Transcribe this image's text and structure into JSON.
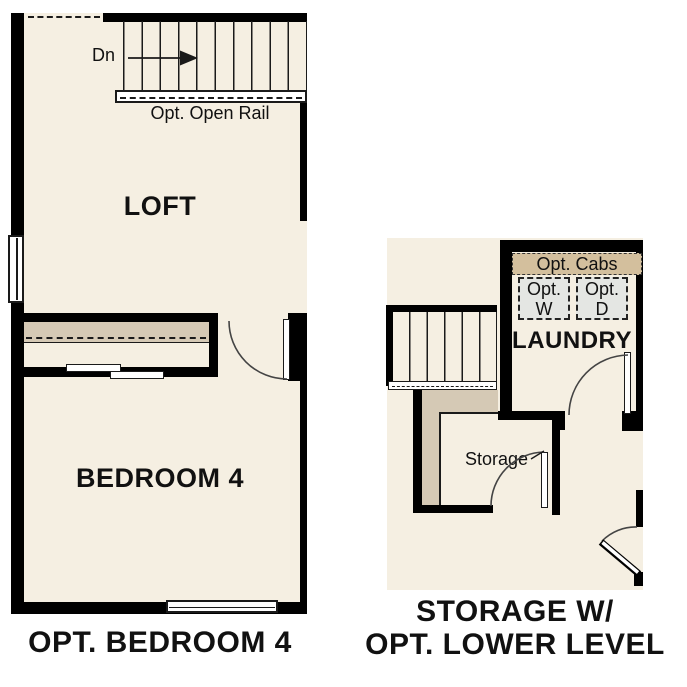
{
  "colors": {
    "floor": "#f5efe2",
    "wall": "#000000",
    "shelf": "#d5c9b5",
    "cabinet": "#d3bf9d",
    "appliance": "#e4e6e3",
    "line": "#1a1a1a"
  },
  "left_plan": {
    "caption": "OPT. BEDROOM 4",
    "loft_label": "LOFT",
    "bedroom_label": "BEDROOM 4",
    "stairs_direction_label": "Dn",
    "rail_label": "Opt. Open Rail"
  },
  "right_plan": {
    "caption_line1": "STORAGE W/",
    "caption_line2": "OPT. LOWER LEVEL",
    "laundry_label": "LAUNDRY",
    "storage_label": "Storage",
    "opt_cabs_label": "Opt. Cabs",
    "opt_washer_label": "Opt.\nW",
    "opt_dryer_label": "Opt.\nD"
  }
}
